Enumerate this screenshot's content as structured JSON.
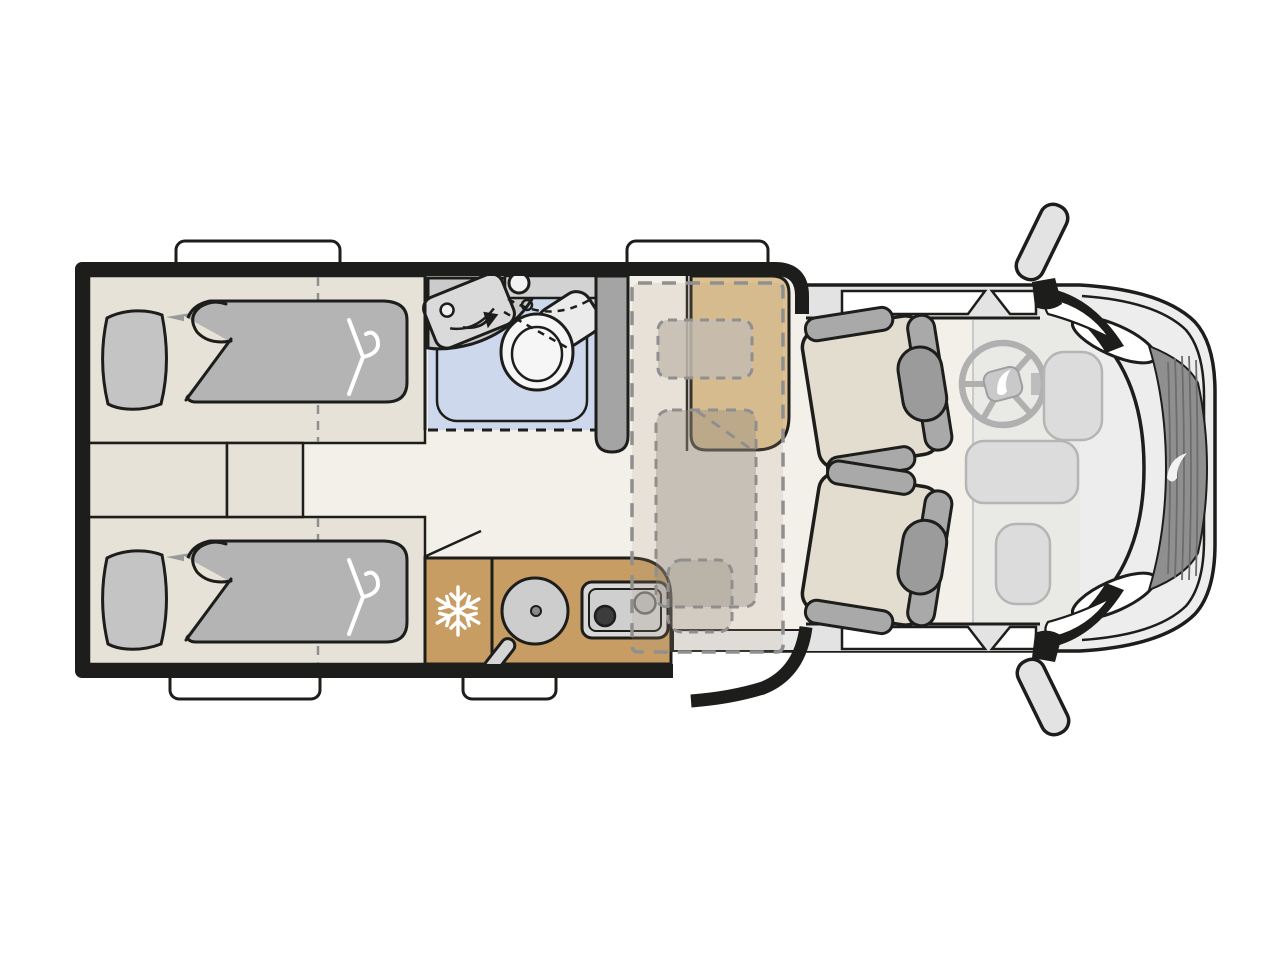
{
  "meta": {
    "title": "Motorhome floor plan (top view)",
    "diagram_type": "camper-van layout illustration",
    "canvas": {
      "width": 1280,
      "height": 960
    }
  },
  "palette": {
    "background": "#ffffff",
    "outline": "#1d1d1b",
    "floor": "#f3f0e9",
    "bed_base": "#e7e2d7",
    "pillow": "#c4c4c4",
    "duvet": "#b4b4b4",
    "textile_shadow": "#9a9a9a",
    "bathroom_blue": "#cdd8ec",
    "fixture_light": "#dadada",
    "fixture_mid": "#cbcbcb",
    "cabinet_gray": "#d2d2d2",
    "pillar_gray": "#a4a4a4",
    "wood_tan": "#c79d63",
    "bench_tan": "#dec192",
    "dash_stroke": "#8f8f8f",
    "overlay_fill": "rgba(180,162,135,0.18)",
    "overlay_textile": "rgba(148,140,129,0.38)",
    "overlay_pillow": "rgba(196,188,177,0.85)",
    "van_body": "#ededed",
    "van_wall": "#e3e3e3",
    "dash_area": "#e9e9e6",
    "seat_cushion": "#e3ddd0",
    "seat_gray": "#a9a9a9",
    "headrest_gray": "#9b9b9b",
    "grille": "#8f8f8f",
    "grille_line": "#6d6d6d",
    "wheel_gray": "#b0b0b0",
    "dash_pill": "#dcdcdc",
    "step_gray": "#e9e9e9",
    "stove_face": "#d8d8d8",
    "burner_dark": "#3c3c3c",
    "white": "#ffffff"
  },
  "floorplan": {
    "view": "top-down",
    "front_of_vehicle": "right",
    "areas": {
      "rear_bedroom": {
        "name": "rear twin bedroom",
        "beds": [
          "single-bed-top",
          "single-bed-bottom"
        ],
        "symbols": [
          "pillow",
          "duvet-with-folded-corner",
          "clothes-hanger",
          "bed-length-dashed-line",
          "step-cabinets-between-beds"
        ]
      },
      "bathroom": {
        "name": "bathroom",
        "fixtures": [
          "swivel-washbasin-with-arrow",
          "round-basin",
          "vanity-cabinet",
          "toilet",
          "shower-tray",
          "sliding-partition-dashed"
        ]
      },
      "wardrobe": {
        "name": "wardrobe pillar"
      },
      "lounge": {
        "name": "dinette lounge",
        "features": [
          "side-bench",
          "drop-down-bed-dashed-outline",
          "drop-down-bed-pillow",
          "drop-down-bed-duvet"
        ]
      },
      "kitchen": {
        "name": "kitchenette",
        "features": [
          "refrigerator-snowflake",
          "round-sink-with-faucet",
          "two-burner-stove",
          "fold-out-worktop-line"
        ]
      },
      "entry": {
        "name": "entry door",
        "state": "open-swing"
      },
      "cab": {
        "name": "driver cab",
        "features": [
          "swivel-seat-driver",
          "swivel-seat-passenger",
          "steering-wheel",
          "dashboard-consoles"
        ]
      },
      "exterior": {
        "features": [
          "window-top-rear",
          "window-top-lounge",
          "window-bottom-rear",
          "window-bottom-kitchen",
          "cab-door-windows",
          "wing-mirror-top",
          "wing-mirror-bottom",
          "windshield",
          "headlights",
          "radiator-grille",
          "brand-swoosh-logo"
        ]
      }
    },
    "icons": {
      "snowflake_icon": "❄ refrigerator",
      "hanger_icon": "clothes hanger (storage under bed)",
      "arrow_icon": "swivel washbasin direction"
    },
    "counts": {
      "sleeping_berths_fixed": 2,
      "sleeping_berths_dropdown": 1,
      "cab_seats": 2,
      "habitation_windows": 4
    }
  }
}
